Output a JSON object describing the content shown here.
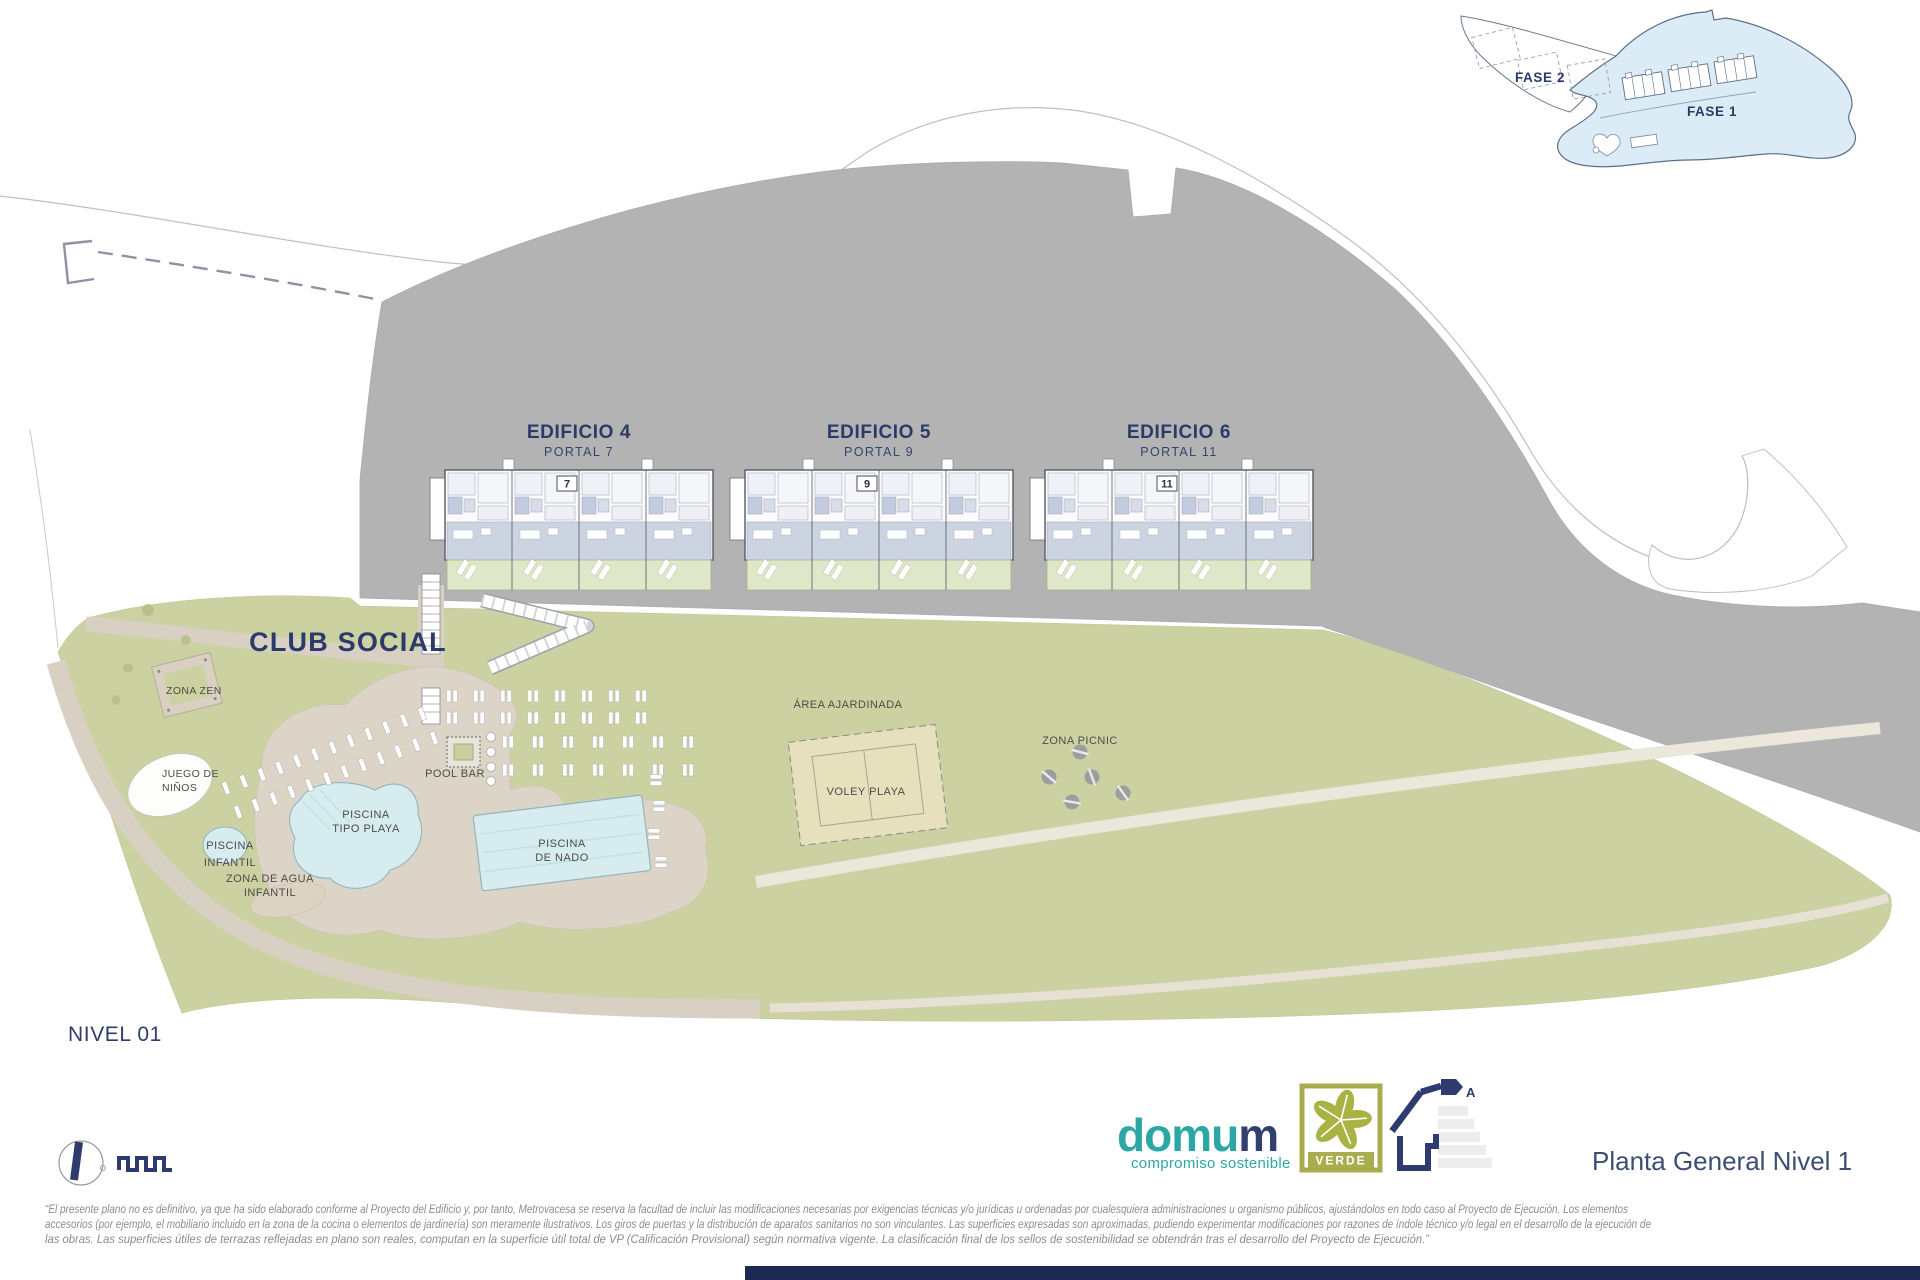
{
  "inset": {
    "fase_2": "FASE 2",
    "fase_1": "FASE 1"
  },
  "buildings": [
    {
      "name": "EDIFICIO 4",
      "portal": "PORTAL 7",
      "plate": "7"
    },
    {
      "name": "EDIFICIO 5",
      "portal": "PORTAL 9",
      "plate": "9"
    },
    {
      "name": "EDIFICIO 6",
      "portal": "PORTAL 11",
      "plate": "11"
    }
  ],
  "labels": {
    "club_social": "CLUB SOCIAL",
    "zona_zen": "ZONA ZEN",
    "juego_ninos_1": "JUEGO DE",
    "juego_ninos_2": "NIÑOS",
    "piscina_infantil_1": "PISCINA",
    "piscina_infantil_2": "INFANTIL",
    "piscina_playa_1": "PISCINA",
    "piscina_playa_2": "TIPO PLAYA",
    "zona_agua_1": "ZONA DE AGUA",
    "zona_agua_2": "INFANTIL",
    "pool_bar": "POOL BAR",
    "piscina_nado_1": "PISCINA",
    "piscina_nado_2": "DE NADO",
    "area_ajardinada": "ÁREA AJARDINADA",
    "voley_playa": "VOLEY PLAYA",
    "zona_picnic": "ZONA PICNIC",
    "nivel": "NIVEL 01"
  },
  "titleblock": {
    "plan_title": "Planta General Nivel 1",
    "brand_primary": "domu",
    "brand_accent": "m",
    "brand_tagline": "compromiso sostenible",
    "badge": "VERDE",
    "energy_rating": "A"
  },
  "disclaimer": {
    "line1": "“El presente plano no es definitivo, ya que ha sido elaborado conforme al Proyecto del Edificio y, por tanto, Metrovacesa se reserva la facultad de incluir las modificaciones necesarias por exigencias técnicas y/o jurídicas u ordenadas por cualesquiera administraciones u organismo públicos, ajustándolos en todo caso al Proyecto de Ejecución. Los elementos",
    "line2": "accesorios (por ejemplo, el mobiliario incluido en la zona de la cocina o elementos de jardinería) son meramente ilustrativos. Los giros de puertas y la distribución de aparatos sanitarios no son vinculantes. Las superficies expresadas son aproximadas, pudiendo experimentar modificaciones por razones de índole técnico y/o legal en el desarrollo de la ejecución de",
    "line3": "las obras. Las superficies útiles de terrazas reflejadas en plano son reales, computan en la superficie útil total de VP (Calificación Provisional) según normativa vigente. La clasificación final de los sellos de sostenibilidad se obtendrán tras el desarrollo del Proyecto de Ejecución.”"
  },
  "colors": {
    "navy": "#2b3a68",
    "teal": "#2ba8a5",
    "site_green": "#ccd1a2",
    "hill_gray": "#b3b3b3",
    "pool_blue": "#d6ecef",
    "path_beige": "#d8d1c3",
    "badge_olive": "#a9ad4e",
    "inset_blue": "#dcecf7",
    "bottom_bar": "#1c2950"
  }
}
